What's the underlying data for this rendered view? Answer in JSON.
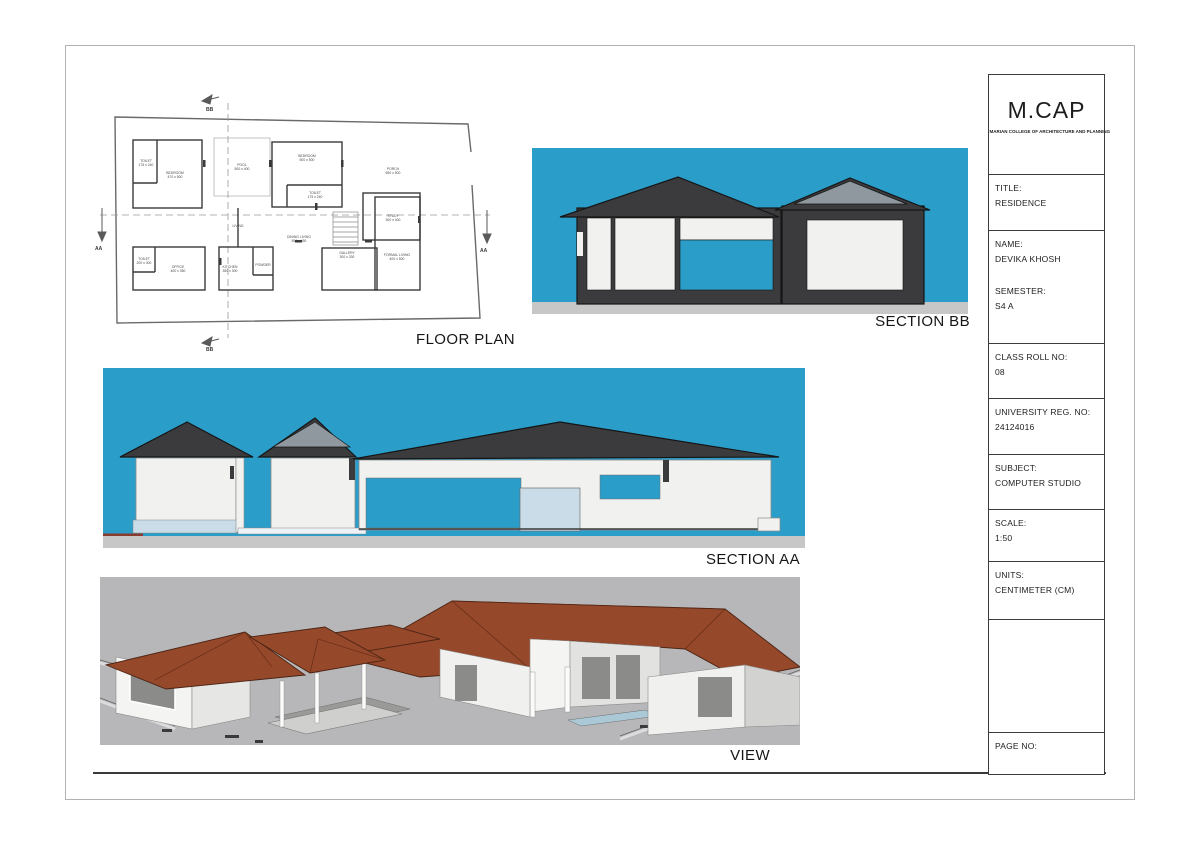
{
  "colors": {
    "section_background_blue": "#2B9DC9",
    "building_dark_gray": "#3B3B3D",
    "roof_highlight_gray": "#8F989F",
    "wall_white": "#F1F1EF",
    "plinth_pale_blue": "#C9DCE7",
    "ground_gray": "#C7C7C7",
    "view_background_gray": "#B7B7B9",
    "view_roof_terracotta": "#96482A"
  },
  "floor_plan": {
    "label": "FLOOR PLAN",
    "marker_aa": "AA",
    "marker_bb": "BB",
    "rooms": [
      {
        "name": "TOILET",
        "dims": "175 x 240",
        "x": 71,
        "y": 72
      },
      {
        "name": "BEDROOM",
        "dims": "470 x 500",
        "x": 100,
        "y": 84
      },
      {
        "name": "POOL",
        "dims": "500 x 400",
        "x": 167,
        "y": 76
      },
      {
        "name": "BEDROOM",
        "dims": "500 x 500",
        "x": 232,
        "y": 67
      },
      {
        "name": "TOILET",
        "dims": "175 x 240",
        "x": 240,
        "y": 104
      },
      {
        "name": "PORCH",
        "dims": "650 x 500",
        "x": 318,
        "y": 80
      },
      {
        "name": "LIVING",
        "dims": "",
        "x": 163,
        "y": 137
      },
      {
        "name": "DINING LIVING",
        "dims": "550 x 450",
        "x": 224,
        "y": 148
      },
      {
        "name": "STUDY",
        "dims": "300 x 400",
        "x": 318,
        "y": 127
      },
      {
        "name": "TOILET",
        "dims": "200 x 300",
        "x": 69,
        "y": 170
      },
      {
        "name": "OFFICE",
        "dims": "400 x 350",
        "x": 103,
        "y": 178
      },
      {
        "name": "KITCHEN",
        "dims": "350 x 300",
        "x": 155,
        "y": 178
      },
      {
        "name": "POWDER",
        "dims": "",
        "x": 188,
        "y": 176
      },
      {
        "name": "GALLERY",
        "dims": "300 x 330",
        "x": 272,
        "y": 164
      },
      {
        "name": "FORMAL LIVING",
        "dims": "400 x 500",
        "x": 322,
        "y": 166
      }
    ]
  },
  "section_bb": {
    "label": "SECTION BB"
  },
  "section_aa": {
    "label": "SECTION AA"
  },
  "view": {
    "label": "VIEW"
  },
  "title_block": {
    "logo": "M.CAP",
    "college": "MARIAN COLLEGE OF ARCHITECTURE AND PLANNING",
    "rows": [
      {
        "fields": [
          {
            "label": "TITLE:",
            "value": "RESIDENCE"
          }
        ]
      },
      {
        "fields": [
          {
            "label": "NAME:",
            "value": "DEVIKA KHOSH"
          },
          {
            "label": "SEMESTER:",
            "value": "S4 A"
          }
        ]
      },
      {
        "fields": [
          {
            "label": "CLASS ROLL NO:",
            "value": "08"
          }
        ]
      },
      {
        "fields": [
          {
            "label": "UNIVERSITY REG. NO:",
            "value": "24124016"
          }
        ]
      },
      {
        "fields": [
          {
            "label": "SUBJECT:",
            "value": "COMPUTER STUDIO"
          }
        ]
      },
      {
        "fields": [
          {
            "label": "SCALE:",
            "value": "1:50"
          }
        ]
      },
      {
        "fields": [
          {
            "label": "UNITS:",
            "value": "CENTIMETER (CM)"
          }
        ]
      },
      {
        "fields": []
      },
      {
        "fields": [
          {
            "label": "PAGE NO:",
            "value": ""
          }
        ]
      }
    ]
  }
}
